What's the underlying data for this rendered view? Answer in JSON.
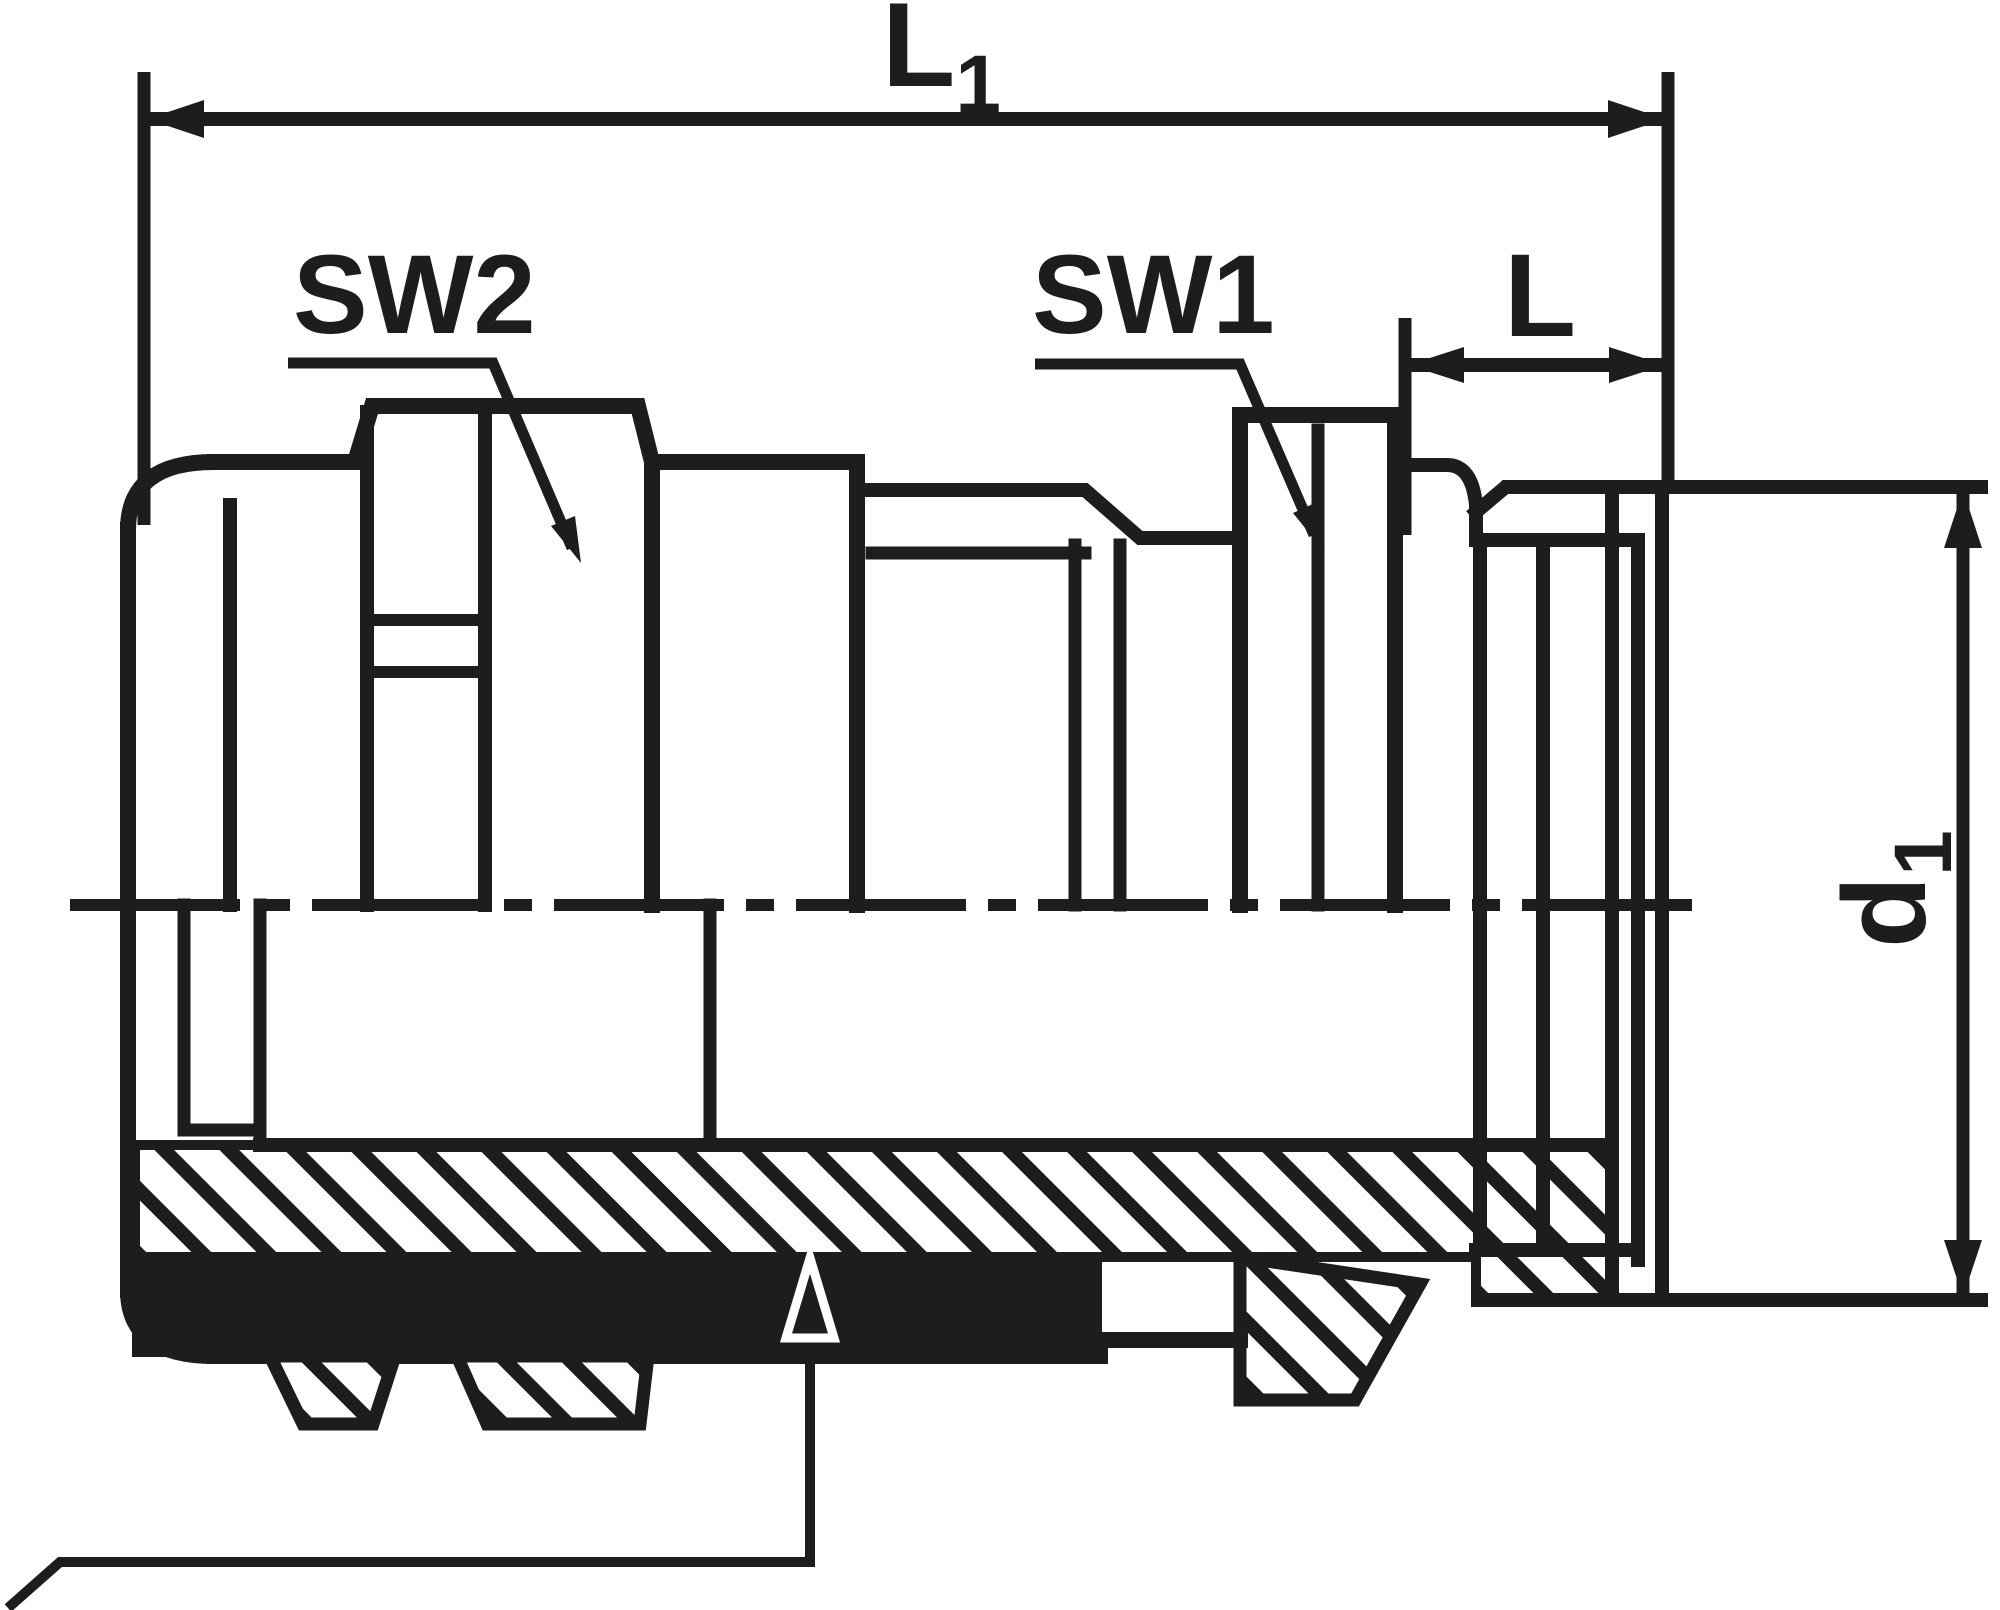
{
  "drawing": {
    "type": "technical-drawing-cable-gland-section",
    "ink_color": "#1d1d1d",
    "background_color": "#ffffff",
    "labels": {
      "l1": {
        "main": "L",
        "sub": "1"
      },
      "sw2": "SW2",
      "sw1": "SW1",
      "l": "L",
      "d1": {
        "main": "d",
        "sub": "1"
      }
    },
    "symbols": {
      "triangle_marker": "triangle-datum-marker",
      "centerline": "dash-dot-centerline",
      "hatching": "section-hatching-45deg"
    }
  }
}
